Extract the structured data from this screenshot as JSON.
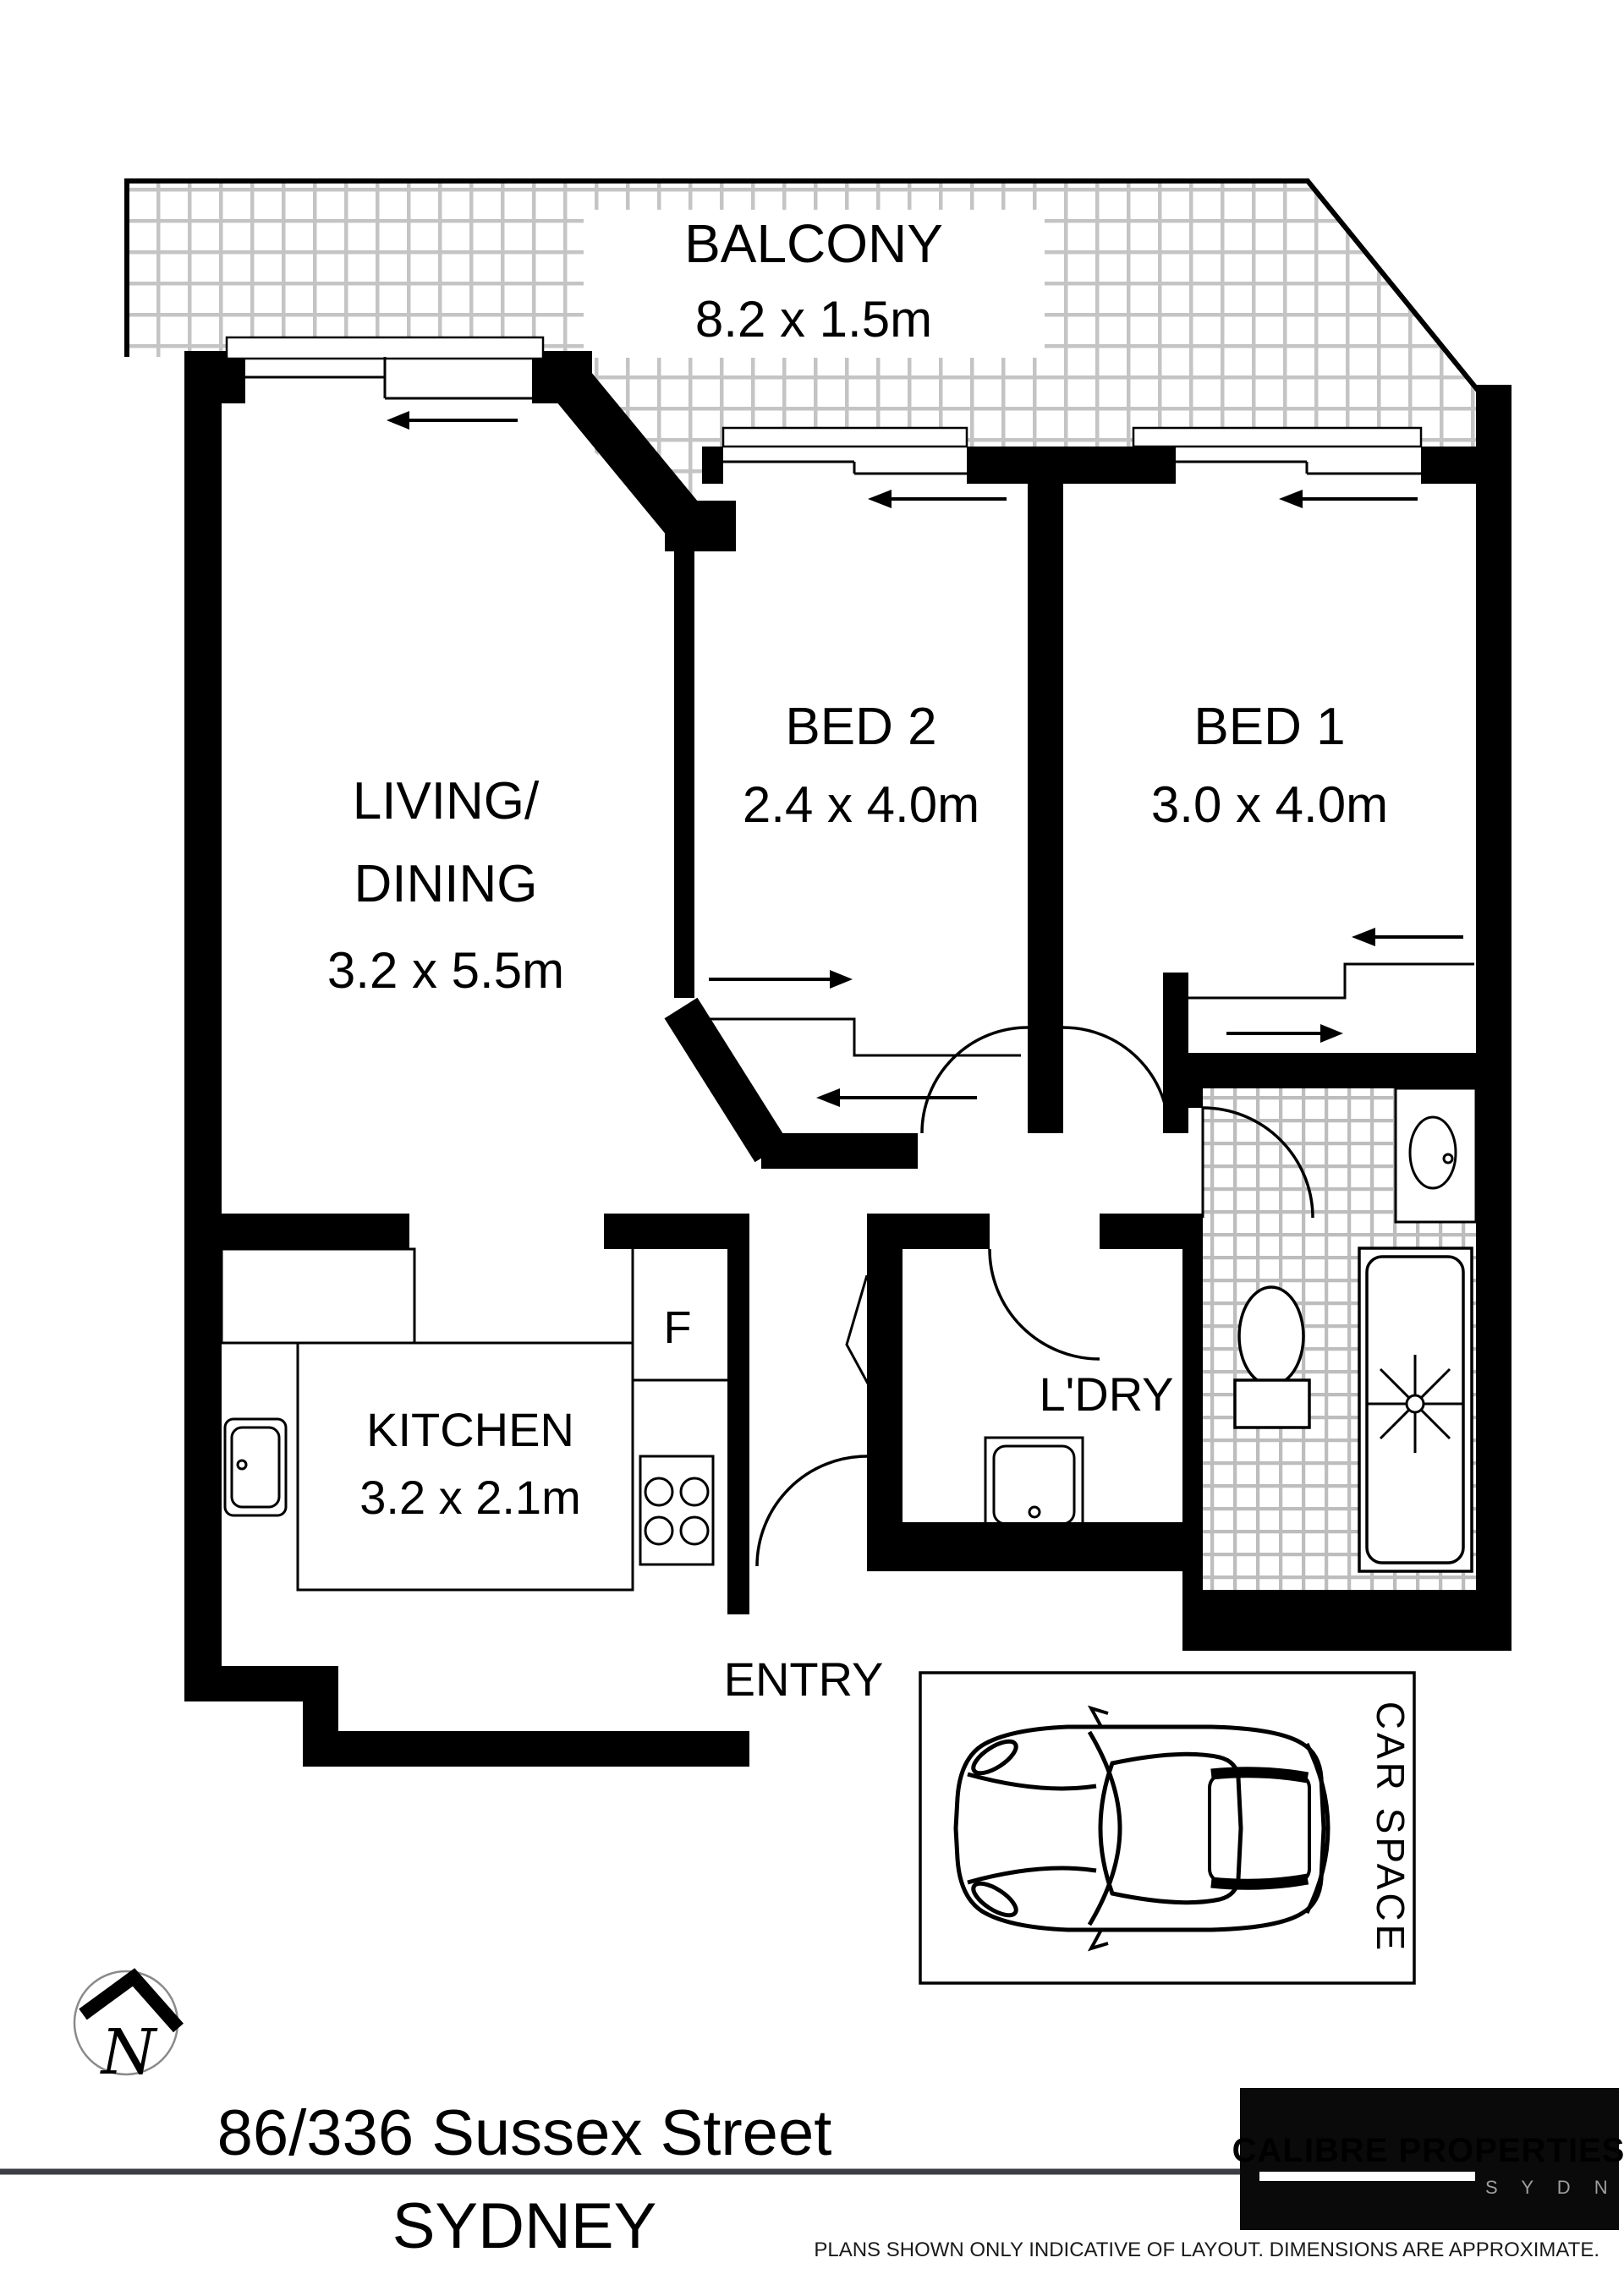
{
  "plan": {
    "balcony": {
      "name": "BALCONY",
      "dims": "8.2 x 1.5m"
    },
    "living": {
      "name_line1": "LIVING/",
      "name_line2": "DINING",
      "dims": "3.2 x 5.5m"
    },
    "bed2": {
      "name": "BED 2",
      "dims": "2.4 x 4.0m"
    },
    "bed1": {
      "name": "BED 1",
      "dims": "3.0 x 4.0m"
    },
    "kitchen": {
      "name": "KITCHEN",
      "dims": "3.2 x 2.1m"
    },
    "fridge_label": "F",
    "laundry_label": "L'DRY",
    "entry_label": "ENTRY",
    "car_space_label": "CAR SPACE",
    "north_label": "N"
  },
  "icons": {
    "north": "north-arrow-icon",
    "car": "car-top-view-icon",
    "shower": "shower-rose-icon",
    "bathtub": "bathtub-icon",
    "toilet": "toilet-icon",
    "basin": "basin-icon",
    "kitchen_sink": "kitchen-sink-icon",
    "laundry_tub": "laundry-tub-icon",
    "stove": "stove-cooktop-icon"
  },
  "footer": {
    "address_line1": "86/336 Sussex Street",
    "address_line2": "SYDNEY",
    "disclaimer": "PLANS SHOWN ONLY INDICATIVE OF LAYOUT. DIMENSIONS ARE APPROXIMATE."
  },
  "logo": {
    "brand": "CALIBRE PROPERTIES",
    "city": "S Y D N E Y",
    "brand_color": "#e0222a",
    "bg_color": "#0a0a0a"
  },
  "colors": {
    "wall": "#000000",
    "balcony_hatch": "#c4c4c4",
    "tile_hatch": "#bdbdbd",
    "divider_line": "#3d3d46"
  }
}
